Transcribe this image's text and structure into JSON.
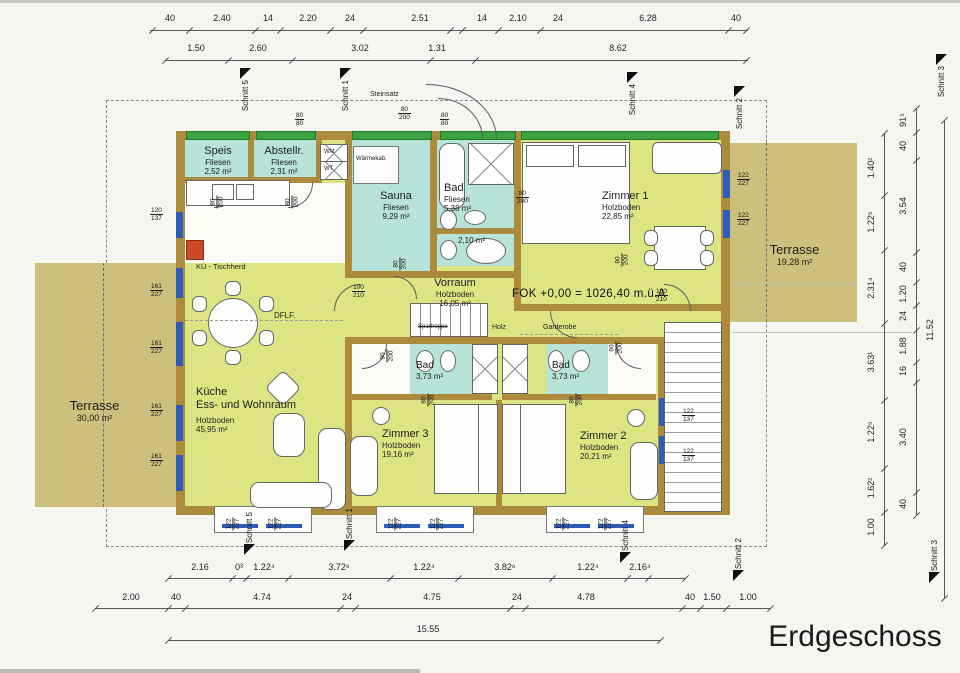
{
  "title": "Erdgeschoss",
  "colors": {
    "wall": "#ac8b3d",
    "room": "#dde583",
    "wet": "#b7e3d8",
    "terrace": "#cdc07c",
    "wingreen": "#3aa23f",
    "winblue": "#2e5cb8",
    "stove_red": "#cc4a28"
  },
  "rooms": {
    "speis": {
      "name": "Speis",
      "floor": "Fliesen",
      "area": "2,52 m²"
    },
    "abstellr": {
      "name": "Abstellr.",
      "floor": "Fliesen",
      "area": "2,31 m²"
    },
    "sauna": {
      "name": "Sauna",
      "floor": "Fliesen",
      "area": "9,29 m²"
    },
    "bad_top": {
      "name": "Bad",
      "floor": "Fliesen",
      "area": "5,38 m²"
    },
    "wc": {
      "area": "2,10 m²"
    },
    "zimmer1": {
      "name": "Zimmer 1",
      "floor": "Holzboden",
      "area": "22,85 m²"
    },
    "vorraum": {
      "name": "Vorraum",
      "floor": "Holzboden",
      "area": "16,05 m²"
    },
    "kueche": {
      "name": "Küche",
      "name2": "Ess- und Wohnraum",
      "floor": "Holzboden",
      "area": "45,95 m²"
    },
    "bad_left": {
      "name": "Bad",
      "area": "3,73 m²"
    },
    "bad_right": {
      "name": "Bad",
      "area": "3,73 m²"
    },
    "zimmer3": {
      "name": "Zimmer 3",
      "floor": "Holzboden",
      "area": "19,16 m²"
    },
    "zimmer2": {
      "name": "Zimmer 2",
      "floor": "Holzboden",
      "area": "20,21 m²"
    },
    "terrasse_right": {
      "name": "Terrasse",
      "area": "19,28 m²"
    },
    "terrasse_left": {
      "name": "Terrasse",
      "area": "30,00 m²"
    },
    "waermekab": {
      "name": "Wärmekab."
    }
  },
  "annotations": {
    "fok": "FOK +0,00 = 1026,40 m.ü.A",
    "steinsatz": "Steinsatz",
    "spartreppe": "Spartreppe",
    "holz": "Holz",
    "garderobe": "Garderobe",
    "dflf": "DFLF.",
    "kue_tischherd": "KÜ - Tischherd",
    "wm": "WM",
    "wt": "WT"
  },
  "dim_chains": [
    {
      "name": "top-row-1",
      "orient": "h",
      "line": {
        "x": 150,
        "y": 30,
        "len": 598
      },
      "ticks": [
        152,
        189,
        255,
        280,
        330,
        363,
        450,
        462,
        498,
        540,
        728,
        746
      ],
      "labels": [
        {
          "t": "40",
          "x": 170,
          "y": 13
        },
        {
          "t": "2.40",
          "x": 222,
          "y": 13
        },
        {
          "t": "14",
          "x": 268,
          "y": 13
        },
        {
          "t": "2.20",
          "x": 308,
          "y": 13
        },
        {
          "t": "24",
          "x": 350,
          "y": 13
        },
        {
          "t": "2.51",
          "x": 420,
          "y": 13
        },
        {
          "t": "14",
          "x": 482,
          "y": 13
        },
        {
          "t": "2.10",
          "x": 518,
          "y": 13
        },
        {
          "t": "24",
          "x": 558,
          "y": 13
        },
        {
          "t": "6.28",
          "x": 648,
          "y": 13
        },
        {
          "t": "40",
          "x": 736,
          "y": 13
        }
      ]
    },
    {
      "name": "top-row-2",
      "orient": "h",
      "line": {
        "x": 165,
        "y": 60,
        "len": 583
      },
      "ticks": [
        165,
        228,
        292,
        430,
        475,
        746
      ],
      "labels": [
        {
          "t": "1.50",
          "x": 196,
          "y": 43
        },
        {
          "t": "2.60",
          "x": 258,
          "y": 43
        },
        {
          "t": "3.02",
          "x": 360,
          "y": 43
        },
        {
          "t": "1.31",
          "x": 437,
          "y": 43
        },
        {
          "t": "8.62",
          "x": 618,
          "y": 43
        }
      ]
    },
    {
      "name": "bottom-row-1",
      "orient": "h",
      "line": {
        "x": 168,
        "y": 578,
        "len": 517
      },
      "ticks": [
        168,
        232,
        246,
        288,
        390,
        458,
        552,
        627,
        648,
        685
      ],
      "labels": [
        {
          "t": "2.16",
          "x": 200,
          "y": 562
        },
        {
          "t": "0³",
          "x": 239,
          "y": 562
        },
        {
          "t": "1.22⁴",
          "x": 264,
          "y": 562
        },
        {
          "t": "3.72⁶",
          "x": 339,
          "y": 562
        },
        {
          "t": "1.22⁴",
          "x": 424,
          "y": 562
        },
        {
          "t": "3.82⁶",
          "x": 505,
          "y": 562
        },
        {
          "t": "1.22⁴",
          "x": 588,
          "y": 562
        },
        {
          "t": "2.16⁴",
          "x": 640,
          "y": 562
        }
      ]
    },
    {
      "name": "bottom-row-2",
      "orient": "h",
      "line": {
        "x": 95,
        "y": 608,
        "len": 675
      },
      "ticks": [
        95,
        168,
        185,
        340,
        355,
        510,
        525,
        682,
        700,
        726,
        770
      ],
      "labels": [
        {
          "t": "2.00",
          "x": 131,
          "y": 592
        },
        {
          "t": "40",
          "x": 176,
          "y": 592
        },
        {
          "t": "4.74",
          "x": 262,
          "y": 592
        },
        {
          "t": "24",
          "x": 347,
          "y": 592
        },
        {
          "t": "4.75",
          "x": 432,
          "y": 592
        },
        {
          "t": "24",
          "x": 517,
          "y": 592
        },
        {
          "t": "4.78",
          "x": 586,
          "y": 592
        },
        {
          "t": "40",
          "x": 690,
          "y": 592
        },
        {
          "t": "1.50",
          "x": 712,
          "y": 592
        },
        {
          "t": "1.00",
          "x": 748,
          "y": 592
        }
      ]
    },
    {
      "name": "bottom-row-3",
      "orient": "h",
      "line": {
        "x": 168,
        "y": 640,
        "len": 492
      },
      "ticks": [
        168,
        660
      ],
      "labels": [
        {
          "t": "15.55",
          "x": 428,
          "y": 624
        }
      ]
    },
    {
      "name": "right-inner",
      "orient": "v",
      "line": {
        "x": 884,
        "y": 133,
        "len": 412
      },
      "ticks": [
        133,
        195,
        250,
        323,
        400,
        468,
        512,
        545
      ],
      "labels": [
        {
          "t": "1.40²",
          "x": 871,
          "y": 168
        },
        {
          "t": "1.22⁵",
          "x": 871,
          "y": 222
        },
        {
          "t": "2.31⁴",
          "x": 871,
          "y": 288
        },
        {
          "t": "3.63¹",
          "x": 871,
          "y": 362
        },
        {
          "t": "1.22⁵",
          "x": 871,
          "y": 432
        },
        {
          "t": "1.62²",
          "x": 871,
          "y": 488
        },
        {
          "t": "1.00",
          "x": 871,
          "y": 527
        }
      ]
    },
    {
      "name": "right-outer",
      "orient": "v",
      "line": {
        "x": 916,
        "y": 108,
        "len": 407
      },
      "ticks": [
        108,
        132,
        160,
        252,
        282,
        305,
        330,
        362,
        382,
        492,
        515
      ],
      "labels": [
        {
          "t": "91⁵",
          "x": 903,
          "y": 120
        },
        {
          "t": "40",
          "x": 903,
          "y": 146
        },
        {
          "t": "3.54",
          "x": 903,
          "y": 206
        },
        {
          "t": "40",
          "x": 903,
          "y": 267
        },
        {
          "t": "1.20",
          "x": 903,
          "y": 294
        },
        {
          "t": "24",
          "x": 903,
          "y": 316
        },
        {
          "t": "1.88",
          "x": 903,
          "y": 346
        },
        {
          "t": "16",
          "x": 903,
          "y": 371
        },
        {
          "t": "3.40",
          "x": 903,
          "y": 437
        },
        {
          "t": "40",
          "x": 903,
          "y": 504
        }
      ]
    },
    {
      "name": "right-overall",
      "orient": "v",
      "line": {
        "x": 944,
        "y": 120,
        "len": 478
      },
      "ticks": [
        120,
        598
      ],
      "labels": [
        {
          "t": "11.52",
          "x": 930,
          "y": 330
        }
      ]
    }
  ],
  "size_marks": [
    {
      "a": "80",
      "b": "80",
      "x": 295,
      "y": 112,
      "rot": 0
    },
    {
      "a": "80",
      "b": "80",
      "x": 440,
      "y": 112,
      "rot": 0
    },
    {
      "a": "80",
      "b": "200",
      "x": 398,
      "y": 106,
      "rot": 0
    },
    {
      "a": "120",
      "b": "137",
      "x": 150,
      "y": 207,
      "rot": 0
    },
    {
      "a": "161",
      "b": "227",
      "x": 150,
      "y": 283,
      "rot": 0
    },
    {
      "a": "161",
      "b": "227",
      "x": 150,
      "y": 340,
      "rot": 0
    },
    {
      "a": "161",
      "b": "227",
      "x": 150,
      "y": 403,
      "rot": 0
    },
    {
      "a": "161",
      "b": "227",
      "x": 150,
      "y": 453,
      "rot": 0
    },
    {
      "a": "122",
      "b": "227",
      "x": 737,
      "y": 172,
      "rot": 0
    },
    {
      "a": "122",
      "b": "227",
      "x": 737,
      "y": 212,
      "rot": 0
    },
    {
      "a": "122",
      "b": "137",
      "x": 682,
      "y": 408,
      "rot": 0
    },
    {
      "a": "122",
      "b": "137",
      "x": 682,
      "y": 448,
      "rot": 0
    },
    {
      "a": "100",
      "b": "210",
      "x": 352,
      "y": 284,
      "rot": 0
    },
    {
      "a": "100",
      "b": "210",
      "x": 655,
      "y": 288,
      "rot": 0
    },
    {
      "a": "80",
      "b": "200",
      "x": 516,
      "y": 190,
      "rot": 0
    },
    {
      "a": "80",
      "b": "200",
      "x": 211,
      "y": 194,
      "rot": 90
    },
    {
      "a": "80",
      "b": "200",
      "x": 286,
      "y": 194,
      "rot": 90
    },
    {
      "a": "80",
      "b": "200",
      "x": 394,
      "y": 256,
      "rot": 90
    },
    {
      "a": "80",
      "b": "200",
      "x": 616,
      "y": 252,
      "rot": 90
    },
    {
      "a": "90",
      "b": "200",
      "x": 381,
      "y": 348,
      "rot": 90
    },
    {
      "a": "90",
      "b": "200",
      "x": 610,
      "y": 340,
      "rot": 90
    },
    {
      "a": "80",
      "b": "200",
      "x": 422,
      "y": 392,
      "rot": 90
    },
    {
      "a": "80",
      "b": "200",
      "x": 570,
      "y": 392,
      "rot": 90
    },
    {
      "a": "122",
      "b": "227",
      "x": 227,
      "y": 516,
      "rot": 90
    },
    {
      "a": "122",
      "b": "227",
      "x": 269,
      "y": 516,
      "rot": 90
    },
    {
      "a": "122",
      "b": "227",
      "x": 389,
      "y": 516,
      "rot": 90
    },
    {
      "a": "122",
      "b": "227",
      "x": 431,
      "y": 516,
      "rot": 90
    },
    {
      "a": "122",
      "b": "227",
      "x": 557,
      "y": 516,
      "rot": 90
    },
    {
      "a": "122",
      "b": "227",
      "x": 599,
      "y": 516,
      "rot": 90
    }
  ],
  "schnitt_markers": [
    {
      "t": "Schnitt 5",
      "x": 240,
      "y": 68,
      "tri": "start"
    },
    {
      "t": "Schnitt 1",
      "x": 340,
      "y": 68,
      "tri": "start"
    },
    {
      "t": "Schnitt 4",
      "x": 627,
      "y": 72,
      "tri": "start"
    },
    {
      "t": "Schnitt 2",
      "x": 734,
      "y": 86,
      "tri": "start"
    },
    {
      "t": "Schnitt 5",
      "x": 244,
      "y": 512,
      "tri": "end"
    },
    {
      "t": "Schnitt 1",
      "x": 344,
      "y": 508,
      "tri": "end"
    },
    {
      "t": "Schnitt 4",
      "x": 620,
      "y": 520,
      "tri": "end"
    },
    {
      "t": "Schnitt 2",
      "x": 733,
      "y": 538,
      "tri": "end"
    },
    {
      "t": "Schnitt 3",
      "x": 936,
      "y": 54,
      "tri": "start"
    },
    {
      "t": "Schnitt 3",
      "x": 929,
      "y": 540,
      "tri": "end"
    }
  ]
}
